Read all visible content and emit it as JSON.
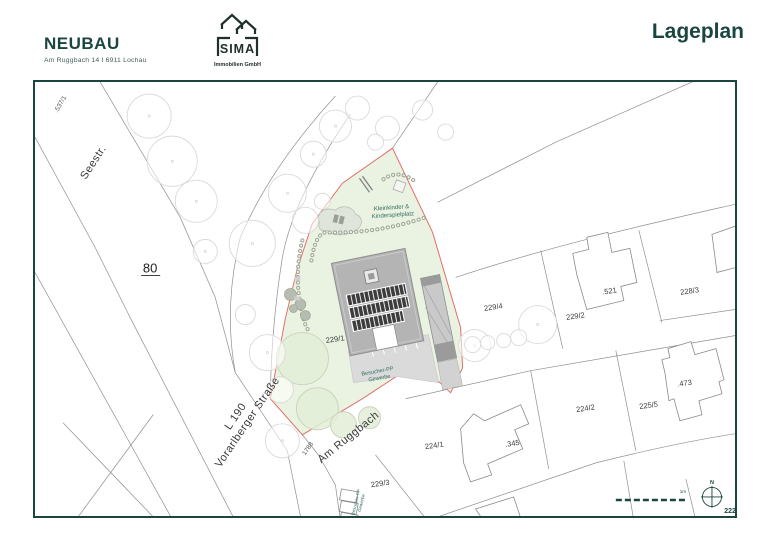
{
  "header": {
    "project_title": "NEUBAU",
    "project_address": "Am Ruggbach 14 I 6911 Lochau",
    "logo_name": "SIMA",
    "logo_subtitle": "Immobilien GmbH",
    "page_title": "Lageplan"
  },
  "colors": {
    "accent": "#1b453f",
    "annotation": "#2f6b60",
    "site_green": "#eaf3e1",
    "site_boundary_red": "#e0706a"
  },
  "map": {
    "streets": {
      "seestr": "Seestr.",
      "road80": "80",
      "l190": "L 190",
      "vorarlberger": "Vorarlberger Straße",
      "am_ruggbach": "Am Ruggbach"
    },
    "parcels": {
      "p537_1": ".537/1",
      "p1788": "1788",
      "p229_1": "229/1",
      "p229_2": "229/2",
      "p229_3": "229/3",
      "p229_4": "229/4",
      "p521": ".521",
      "p228_3": "228/3",
      "p224_1": "224/1",
      "p224_2": "224/2",
      "p225_5": "225/5",
      "p473": ".473",
      "p345": ".345",
      "p222_1": "222/1"
    },
    "annotations": {
      "playground_line1": "Kleinkinder &",
      "playground_line2": "Kinderspielplatz",
      "visitor_parking_line1": "Besucher-PP",
      "visitor_parking_line2": "Gewerbe"
    },
    "scale_label": "1m",
    "north_label": "N"
  }
}
